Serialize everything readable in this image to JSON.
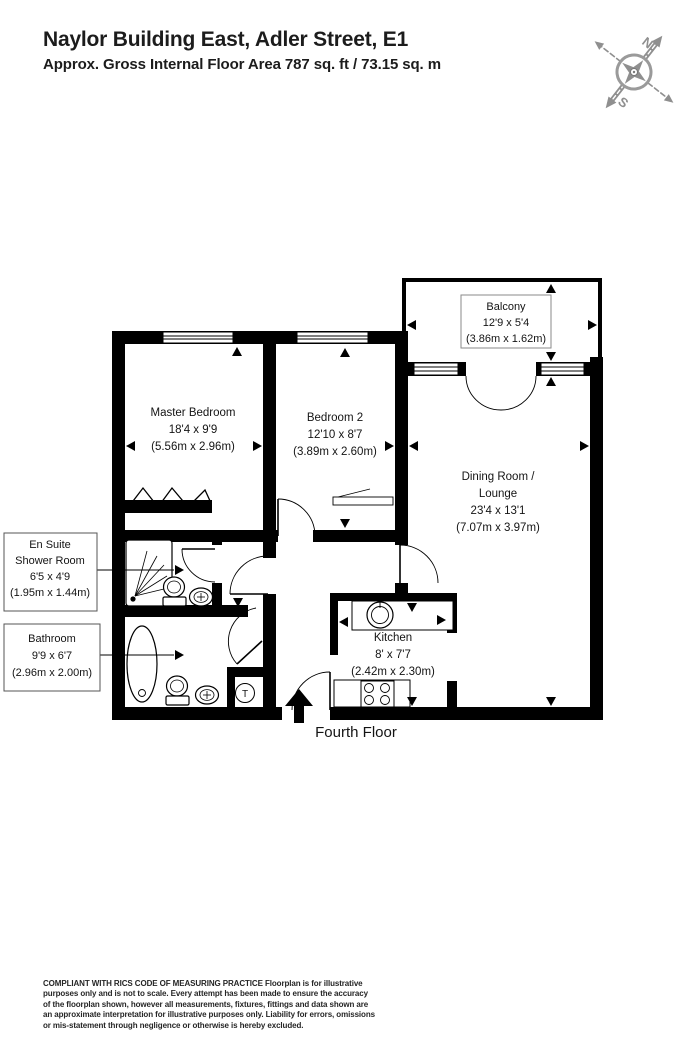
{
  "header": {
    "title": "Naylor Building East, Adler Street, E1",
    "subtitle": "Approx. Gross Internal Floor Area 787 sq. ft / 73.15 sq. m"
  },
  "compass": {
    "north": "N",
    "south": "S"
  },
  "rooms": {
    "master_bedroom": {
      "name": "Master Bedroom",
      "imperial": "18'4 x 9'9",
      "metric": "(5.56m x 2.96m)"
    },
    "bedroom2": {
      "name": "Bedroom 2",
      "imperial": "12'10 x 8'7",
      "metric": "(3.89m x 2.60m)"
    },
    "dining": {
      "name_line1": "Dining Room /",
      "name_line2": "Lounge",
      "imperial": "23'4 x 13'1",
      "metric": "(7.07m x 3.97m)"
    },
    "balcony": {
      "name": "Balcony",
      "imperial": "12'9 x 5'4",
      "metric": "(3.86m x 1.62m)"
    },
    "kitchen": {
      "name": "Kitchen",
      "imperial": "8' x 7'7",
      "metric": "(2.42m x 2.30m)"
    },
    "ensuite": {
      "name_line1": "En Suite",
      "name_line2": "Shower Room",
      "imperial": "6'5 x 4'9",
      "metric": "(1.95m x 1.44m)"
    },
    "bathroom": {
      "name": "Bathroom",
      "imperial": "9'9 x 6'7",
      "metric": "(2.96m x 2.00m)"
    }
  },
  "fixtures": {
    "tank_symbol": "T"
  },
  "floor_label": "Fourth Floor",
  "footer": {
    "text": "COMPLIANT WITH RICS CODE OF MEASURING PRACTICE  Floorplan is for illustrative purposes only and is not to scale. Every attempt has been made to ensure the accuracy of the floorplan shown, however all measurements, fixtures, fittings and data shown are an approximate interpretation for illustrative purposes only. Liability for errors, omissions or mis-statement through negligence or otherwise is hereby excluded."
  },
  "colors": {
    "wall": "#000000",
    "compass_gray": "#8f8f8f",
    "text": "#1b1b1b"
  }
}
